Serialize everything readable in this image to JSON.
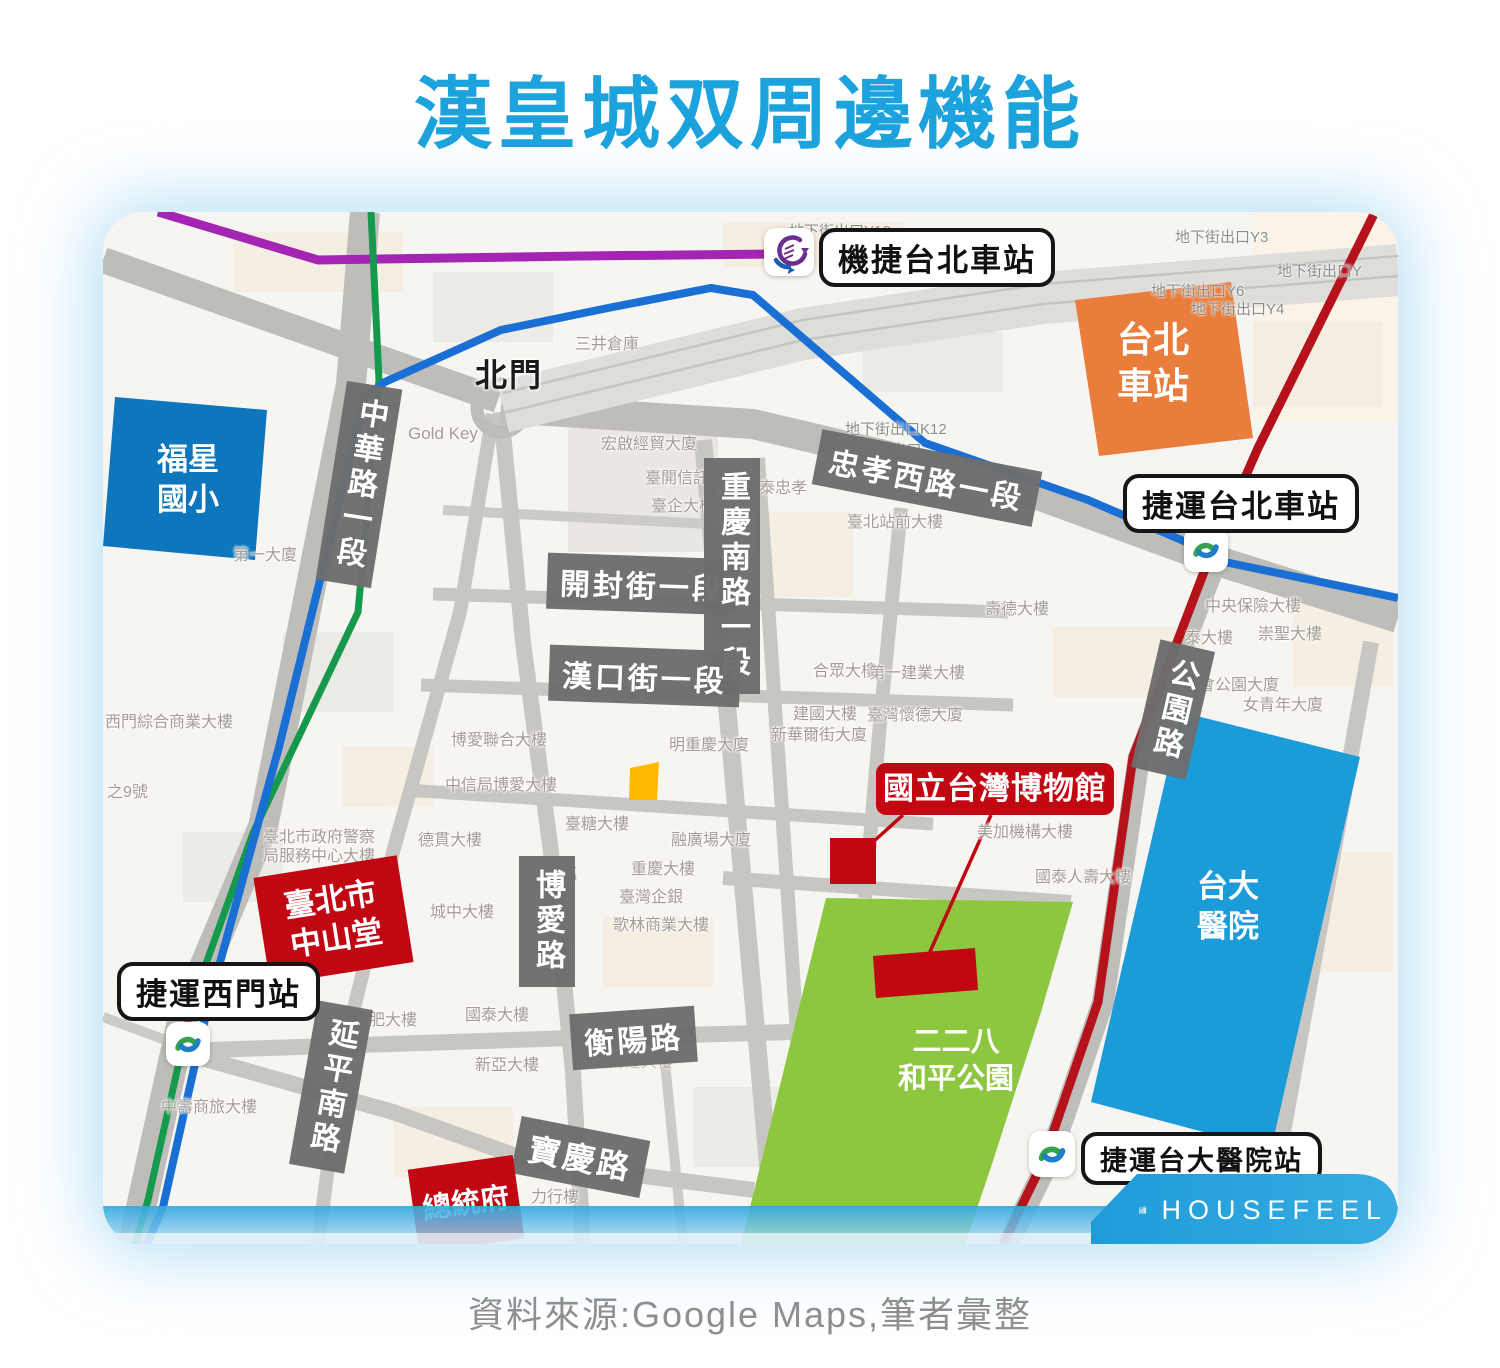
{
  "page": {
    "title": "漢皇城双周邊機能",
    "source_note": "資料來源:Google Maps,筆者彙整"
  },
  "brand": {
    "name": "HOUSEFEEL"
  },
  "colors": {
    "title_blue": "#1CA2DC",
    "airport_mrt_line": "#A424B4",
    "songshan_xindian_line": "#159A4D",
    "bannan_line": "#1A6FD4",
    "tamsui_line": "#B5121B",
    "school_block": "#0E76BC",
    "hospital_block": "#1B9CD9",
    "park_block": "#8CC73F",
    "station_block": "#E87D3C",
    "landmark_red": "#C00712",
    "site_yellow": "#FFB900",
    "road_label_bg": "#6D6D6D",
    "brand_blue": "#259FDA"
  },
  "stations": [
    {
      "label": "機捷台北車站"
    },
    {
      "label": "捷運台北車站"
    },
    {
      "label": "捷運西門站"
    },
    {
      "label": "捷運台大醫院站"
    }
  ],
  "roads": [
    {
      "label": "中華路一段"
    },
    {
      "label": "忠孝西路一段"
    },
    {
      "label": "開封街一段"
    },
    {
      "label": "重慶南路一段"
    },
    {
      "label": "漢口街一段"
    },
    {
      "label": "公園路"
    },
    {
      "label": "博愛路"
    },
    {
      "label": "延平南路"
    },
    {
      "label": "衡陽路"
    },
    {
      "label": "寶慶路"
    }
  ],
  "places": {
    "north_gate": {
      "label": "北門"
    },
    "taipei_station": {
      "line1": "台北",
      "line2": "車站"
    },
    "fuxing_school": {
      "line1": "福星",
      "line2": "國小"
    },
    "ntu_hospital": {
      "line1": "台大",
      "line2": "醫院"
    },
    "peace_park": {
      "line1": "二二八",
      "line2": "和平公園"
    },
    "zhongshan_hall": {
      "line1": "臺北市",
      "line2": "中山堂"
    },
    "presidential_office": {
      "label": "總統府"
    },
    "museum": {
      "label": "國立台灣博物館"
    }
  },
  "buildings": [
    {
      "text": "三井倉庫"
    },
    {
      "text": "Gold Key"
    },
    {
      "text": "宏啟經貿大廈"
    },
    {
      "text": "臺開信託大樓"
    },
    {
      "text": "臺企大樓"
    },
    {
      "text": "基泰忠孝"
    },
    {
      "text": "臺北站前大樓"
    },
    {
      "text": "壽德大樓"
    },
    {
      "text": "中央保險大樓"
    },
    {
      "text": "泰大樓"
    },
    {
      "text": "崇聖大樓"
    },
    {
      "text": "國會公園大廈"
    },
    {
      "text": "女青年大廈"
    },
    {
      "text": "合眾大樓"
    },
    {
      "text": "第一建業大樓"
    },
    {
      "text": "臺灣懷德大廈"
    },
    {
      "text": "建國大樓"
    },
    {
      "text": "新華爾街大廈"
    },
    {
      "text": "明重慶大廈"
    },
    {
      "text": "博愛聯合大樓"
    },
    {
      "text": "中信局博愛大樓"
    },
    {
      "text": "臺糖大樓"
    },
    {
      "text": "融廣場大廈"
    },
    {
      "text": "重慶大樓"
    },
    {
      "text": "臺灣企銀"
    },
    {
      "text": "歌林商業大樓"
    },
    {
      "text": "德貫大樓"
    },
    {
      "text": "城中大樓"
    },
    {
      "text": "美加機構大樓"
    },
    {
      "text": "國泰人壽大樓"
    },
    {
      "text": "合肥大樓"
    },
    {
      "text": "國泰大樓"
    },
    {
      "text": "新亞大樓"
    },
    {
      "text": "中壽商旅大樓"
    },
    {
      "text": "力行樓"
    },
    {
      "text": "衡陽財經大樓"
    },
    {
      "text": "西門綜合商業大樓"
    },
    {
      "text": "之9號"
    },
    {
      "text": "第一大廈"
    },
    {
      "text": "臺北市政府警察"
    },
    {
      "text": "局服務中心大樓"
    },
    {
      "text": "君臨"
    }
  ],
  "exits": [
    {
      "text": "地下街出口Y18"
    },
    {
      "text": "下街出口Y10"
    },
    {
      "text": "地下街出口Y3"
    },
    {
      "text": "地下街出口Y6"
    },
    {
      "text": "地下街出口Y4"
    },
    {
      "text": "地下街出口Y"
    },
    {
      "text": "地下街出口K12"
    },
    {
      "text": "街Z3出口"
    }
  ]
}
